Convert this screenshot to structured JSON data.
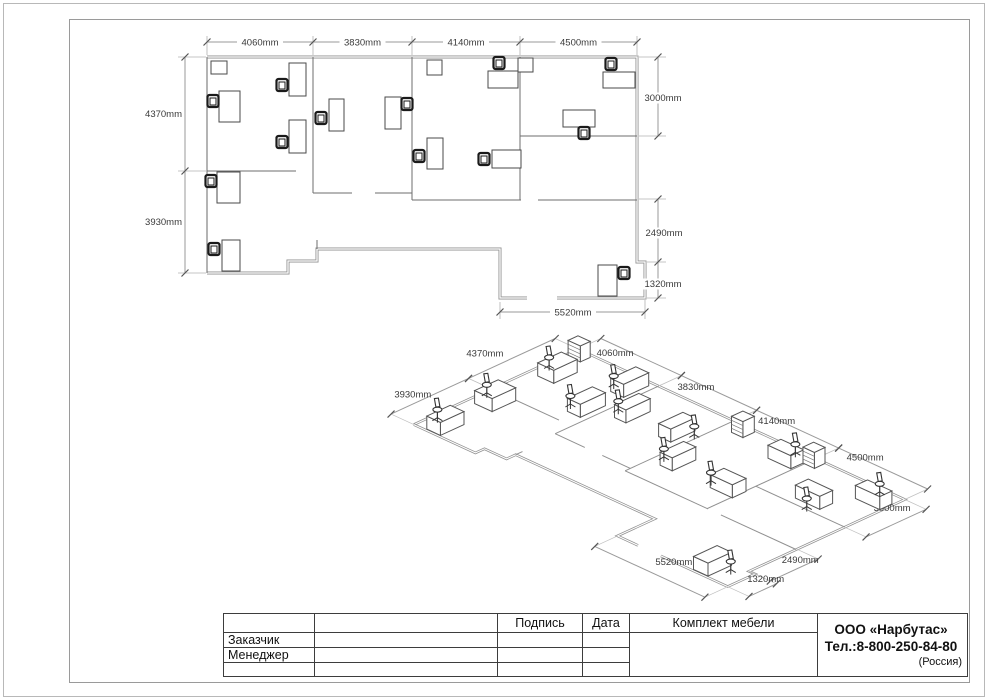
{
  "plan_dims": {
    "top": [
      "4060mm",
      "3830mm",
      "4140mm",
      "4500mm"
    ],
    "left": [
      "4370mm",
      "3930mm"
    ],
    "right": [
      "3000mm",
      "2490mm",
      "1320mm"
    ],
    "bottom": [
      "5520mm"
    ]
  },
  "iso_dims": {
    "top": [
      "4060mm",
      "3830mm",
      "4140mm",
      "4500mm"
    ],
    "left": [
      "4370mm",
      "3930mm"
    ],
    "right": [
      "3000mm",
      "2490mm",
      "1320mm"
    ],
    "bottom": [
      "5520mm"
    ]
  },
  "title_block": {
    "headers": {
      "signature": "Подпись",
      "date": "Дата",
      "set": "Комплект мебели"
    },
    "rows": [
      "Заказчик",
      "Менеджер",
      ""
    ],
    "company": {
      "name": "ООО «Нарбутас»",
      "phone": "Тел.:8-800-250-84-80",
      "country": "(Россия)"
    }
  },
  "colors": {
    "wall": "#909090",
    "interior_wall": "#6e6e6e",
    "furniture": "#4a4a4a",
    "chair": "#1a1a1a",
    "dim_line": "#9a9a9a",
    "dim_text": "#3a3a3a",
    "frame": "#9a9a9a",
    "page_border": "#b8b8b8",
    "table_line": "#3d3d3d"
  }
}
